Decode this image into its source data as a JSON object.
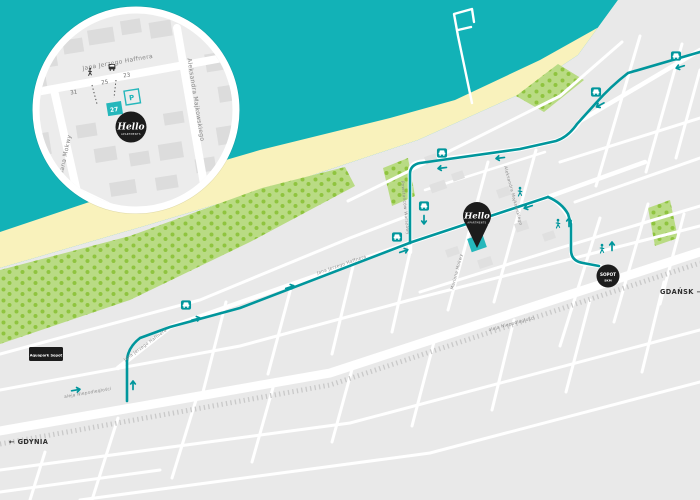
{
  "map_title": "Hello apartments Sopot location map",
  "colors": {
    "sea": "#12b2b7",
    "beach": "#f9f2bc",
    "land": "#e9e9e9",
    "park": "#b9db84",
    "park_trees": "#8fc43f",
    "route": "#00969c",
    "accent": "#25b7bb",
    "badge": "#1c1c1c",
    "street": "#ffffff",
    "railway": "#c9c9c9"
  },
  "labels": {
    "gdansk": "GDAŃSK →",
    "gdynia": "← GDYNIA",
    "aquapark": "Aquapark Sopot"
  },
  "station": {
    "name": "SOPOT",
    "sub": "SKM"
  },
  "brand": {
    "name": "Hello",
    "sub": "APARTMENTS"
  },
  "streets": {
    "haffnera": "Jana Jerzego Haffnera",
    "majkowskiego": "Aleksandra Majkowskiego",
    "mokwy": "Mariana Mokwy",
    "powstancow": "Powstańców Warszawy",
    "niepodleglosci": "aleja Niepodległości"
  },
  "inset": {
    "numbers": [
      "31",
      "25",
      "23"
    ],
    "unit": "27",
    "parking": "P"
  }
}
